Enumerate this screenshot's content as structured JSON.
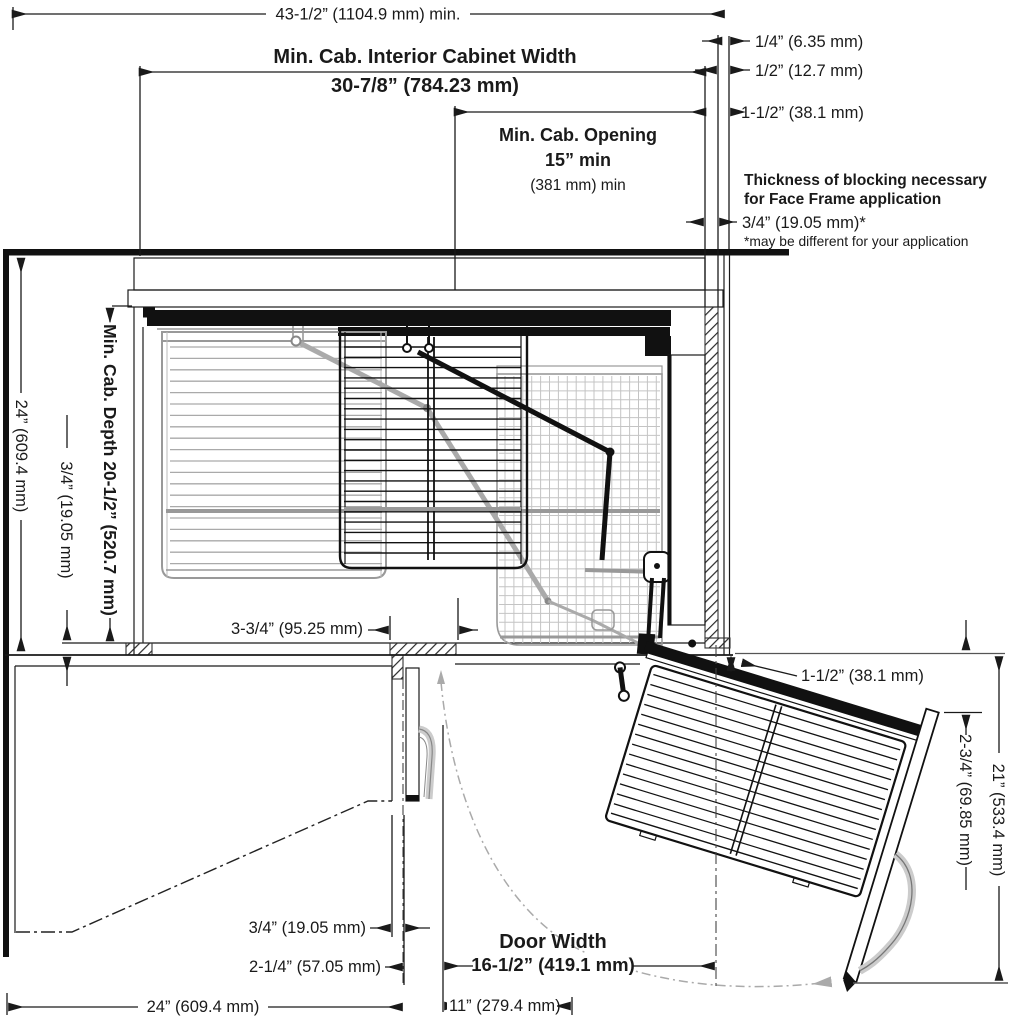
{
  "diagram_title": "Blind corner cabinet pull-out installation plan view",
  "dims": {
    "overall_width": "43-1/2” (1104.9 mm) min.",
    "interior_width_label": "Min. Cab. Interior Cabinet Width",
    "interior_width_value": "30-7/8” (784.23 mm)",
    "opening_label": "Min. Cab. Opening",
    "opening_value": "15” min",
    "opening_metric": "(381 mm) min",
    "reveal_quarter": "1/4” (6.35 mm)",
    "reveal_half": "1/2” (12.7 mm)",
    "reveal_one_half": "1-1/2” (38.1 mm)",
    "blocking_line1": "Thickness of blocking necessary",
    "blocking_line2": "for Face Frame application",
    "blocking_value": "3/4” (19.05 mm)*",
    "blocking_footnote": "*may be different for your application",
    "wall_depth": "24” (609.4 mm)",
    "cab_depth": "Min. Cab. Depth 20-1/2” (520.7 mm)",
    "face_frame_thickness": "3/4” (19.05 mm)",
    "stile_width": "3-3/4” (95.25 mm)",
    "hinge_gap": "1-1/2” (38.1 mm)",
    "door_overhang": "2-3/4” (69.85 mm)",
    "pullout_depth": "21” (533.4 mm)",
    "door_thickness": "3/4” (19.05 mm)",
    "door_clearance": "2-1/4” (57.05 mm)",
    "counter_depth": "24” (609.4 mm)",
    "door_width_label": "Door Width",
    "door_width_value": "16-1/2” (419.1 mm)",
    "opening_width": "11” (279.4 mm)"
  }
}
